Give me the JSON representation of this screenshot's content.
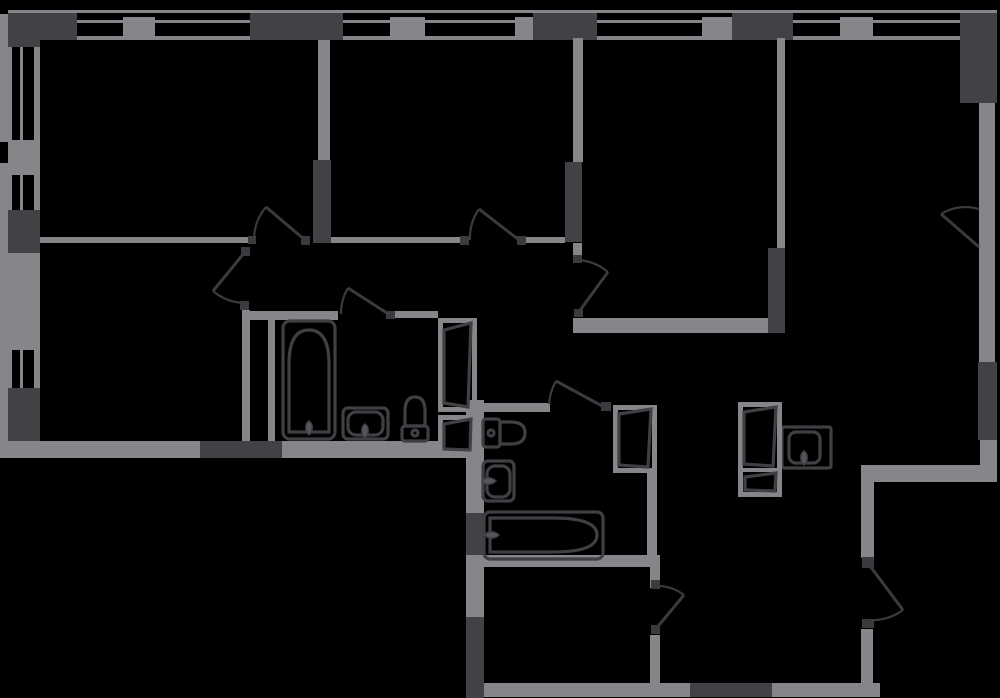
{
  "canvas": {
    "w": 1000,
    "h": 698,
    "bg": "#000000"
  },
  "palette": {
    "wall": "#85858a",
    "dark": "#414146",
    "line": "#3a3a3f",
    "fixture": "#3f3f44",
    "tap_fill": "#55555c",
    "panel_fill": "#000000"
  },
  "walls": [
    [
      8,
      10,
      989,
      3,
      "wall",
      "facade-line-top"
    ],
    [
      8,
      13,
      69,
      27,
      "dark",
      "wall-pier"
    ],
    [
      250,
      13,
      93,
      27,
      "dark",
      "wall-pier"
    ],
    [
      533,
      13,
      64,
      27,
      "dark",
      "wall-pier"
    ],
    [
      732,
      13,
      61,
      27,
      "dark",
      "wall-pier"
    ],
    [
      960,
      13,
      37,
      90,
      "dark",
      "wall-pier-corner"
    ],
    [
      123,
      17,
      32,
      23,
      "wall",
      "window-mullion"
    ],
    [
      390,
      17,
      35,
      23,
      "wall",
      "window-mullion"
    ],
    [
      515,
      17,
      18,
      23,
      "wall",
      "window-mullion"
    ],
    [
      702,
      17,
      30,
      23,
      "wall",
      "window-mullion"
    ],
    [
      840,
      17,
      33,
      23,
      "wall",
      "window-mullion"
    ],
    [
      77,
      20,
      46,
      3,
      "wall",
      "window-glazing"
    ],
    [
      155,
      20,
      95,
      3,
      "wall",
      "window-glazing"
    ],
    [
      343,
      20,
      47,
      3,
      "wall",
      "window-glazing"
    ],
    [
      425,
      20,
      90,
      3,
      "wall",
      "window-glazing"
    ],
    [
      597,
      20,
      105,
      3,
      "wall",
      "window-glazing"
    ],
    [
      793,
      20,
      47,
      3,
      "wall",
      "window-glazing"
    ],
    [
      873,
      20,
      87,
      3,
      "wall",
      "window-glazing"
    ],
    [
      77,
      36,
      46,
      4,
      "wall",
      "window-sill"
    ],
    [
      155,
      36,
      95,
      4,
      "wall",
      "window-sill"
    ],
    [
      343,
      36,
      47,
      4,
      "wall",
      "window-sill"
    ],
    [
      425,
      36,
      90,
      4,
      "wall",
      "window-sill"
    ],
    [
      597,
      36,
      105,
      4,
      "wall",
      "window-sill"
    ],
    [
      793,
      36,
      47,
      4,
      "wall",
      "window-sill"
    ],
    [
      873,
      36,
      87,
      4,
      "wall",
      "window-sill"
    ],
    [
      0,
      14,
      12,
      128,
      "wall",
      "facade-line-left"
    ],
    [
      0,
      163,
      12,
      295,
      "wall",
      "facade-line-left"
    ],
    [
      8,
      13,
      32,
      34,
      "dark",
      "wall-pier"
    ],
    [
      8,
      210,
      32,
      43,
      "dark",
      "wall-pier"
    ],
    [
      8,
      388,
      32,
      53,
      "dark",
      "wall-pier"
    ],
    [
      8,
      140,
      32,
      35,
      "wall",
      "window-mullion"
    ],
    [
      8,
      253,
      32,
      97,
      "wall",
      "wall-segment"
    ],
    [
      20,
      47,
      3,
      93,
      "wall",
      "window-glazing"
    ],
    [
      34,
      47,
      6,
      93,
      "wall",
      "window-sill"
    ],
    [
      20,
      175,
      3,
      35,
      "wall",
      "window-glazing"
    ],
    [
      34,
      175,
      6,
      35,
      "wall",
      "window-sill"
    ],
    [
      20,
      350,
      3,
      38,
      "wall",
      "window-glazing"
    ],
    [
      34,
      350,
      6,
      38,
      "wall",
      "window-sill"
    ],
    [
      8,
      441,
      192,
      17,
      "wall",
      "wall-segment"
    ],
    [
      200,
      441,
      82,
      17,
      "dark",
      "wall-segment-dark"
    ],
    [
      282,
      441,
      192,
      17,
      "wall",
      "wall-segment"
    ],
    [
      40,
      237,
      208,
      6,
      "wall",
      "wall-segment"
    ],
    [
      313,
      160,
      18,
      83,
      "dark",
      "wall-segment-dark"
    ],
    [
      318,
      40,
      12,
      120,
      "wall",
      "wall-segment"
    ],
    [
      331,
      237,
      129,
      6,
      "wall",
      "wall-segment"
    ],
    [
      526,
      237,
      39,
      6,
      "wall",
      "wall-segment"
    ],
    [
      565,
      162,
      17,
      80,
      "dark",
      "wall-segment-dark"
    ],
    [
      573,
      38,
      10,
      124,
      "wall",
      "wall-segment"
    ],
    [
      573,
      243,
      9,
      12,
      "wall",
      "wall-segment"
    ],
    [
      573,
      318,
      197,
      15,
      "wall",
      "wall-segment"
    ],
    [
      768,
      248,
      17,
      85,
      "dark",
      "wall-segment-dark"
    ],
    [
      777,
      38,
      8,
      210,
      "wall",
      "wall-segment"
    ],
    [
      242,
      310,
      8,
      131,
      "wall",
      "wall-segment"
    ],
    [
      242,
      311,
      96,
      9,
      "wall",
      "wall-segment"
    ],
    [
      394,
      311,
      44,
      7,
      "wall",
      "wall-segment"
    ],
    [
      268,
      318,
      7,
      123,
      "wall",
      "wall-segment"
    ],
    [
      466,
      400,
      18,
      113,
      "wall",
      "wall-segment"
    ],
    [
      466,
      513,
      18,
      44,
      "dark",
      "wall-segment-dark"
    ],
    [
      466,
      557,
      18,
      60,
      "wall",
      "wall-segment"
    ],
    [
      466,
      617,
      18,
      81,
      "dark",
      "wall-segment-dark"
    ],
    [
      466,
      403,
      84,
      9,
      "wall",
      "wall-segment"
    ],
    [
      647,
      473,
      10,
      92,
      "wall",
      "wall-segment"
    ],
    [
      466,
      555,
      193,
      12,
      "wall",
      "wall-segment"
    ],
    [
      650,
      555,
      10,
      33,
      "wall",
      "wall-segment"
    ],
    [
      650,
      635,
      10,
      48,
      "wall",
      "wall-segment"
    ],
    [
      484,
      683,
      206,
      14,
      "wall",
      "wall-segment"
    ],
    [
      690,
      683,
      82,
      14,
      "dark",
      "wall-segment-dark"
    ],
    [
      772,
      683,
      108,
      14,
      "wall",
      "wall-segment"
    ],
    [
      861,
      465,
      13,
      93,
      "wall",
      "wall-segment"
    ],
    [
      861,
      629,
      12,
      54,
      "wall",
      "wall-segment"
    ],
    [
      863,
      465,
      134,
      17,
      "wall",
      "wall-segment"
    ],
    [
      978,
      13,
      19,
      90,
      "dark",
      "wall-segment-dark"
    ],
    [
      979,
      103,
      16,
      259,
      "wall",
      "window-band-right"
    ],
    [
      978,
      362,
      19,
      78,
      "dark",
      "wall-segment-dark"
    ],
    [
      980,
      440,
      17,
      28,
      "wall",
      "wall-segment"
    ]
  ],
  "hinges": [
    [
      248,
      236,
      8,
      8
    ],
    [
      301,
      236,
      9,
      9
    ],
    [
      460,
      236,
      9,
      9
    ],
    [
      517,
      236,
      9,
      9
    ],
    [
      241,
      247,
      9,
      9
    ],
    [
      240,
      301,
      9,
      9
    ],
    [
      386,
      311,
      9,
      8
    ],
    [
      573,
      255,
      9,
      8
    ],
    [
      574,
      309,
      9,
      8
    ],
    [
      601,
      402,
      10,
      9
    ],
    [
      651,
      580,
      9,
      9
    ],
    [
      651,
      625,
      9,
      9
    ],
    [
      862,
      557,
      12,
      11
    ],
    [
      862,
      619,
      12,
      9
    ]
  ],
  "doors": [
    {
      "name": "door-bedroom-top-left",
      "h": [
        305,
        240
      ],
      "t": [
        266,
        207
      ],
      "j": [
        254,
        240
      ],
      "r": 51,
      "s": 0
    },
    {
      "name": "door-bedroom-top-mid",
      "h": [
        519,
        240
      ],
      "t": [
        479,
        209
      ],
      "j": [
        470,
        240
      ],
      "r": 50,
      "s": 0
    },
    {
      "name": "door-bedroom-bottom-left",
      "h": [
        245,
        252
      ],
      "t": [
        213,
        291
      ],
      "j": [
        244,
        303
      ],
      "r": 51,
      "s": 0
    },
    {
      "name": "door-bathroom-1",
      "h": [
        390,
        315
      ],
      "t": [
        348,
        288
      ],
      "j": [
        341,
        314
      ],
      "r": 49,
      "s": 0
    },
    {
      "name": "door-bedroom-mid-right",
      "h": [
        578,
        313
      ],
      "t": [
        608,
        272
      ],
      "j": [
        578,
        260
      ],
      "r": 52,
      "s": 0
    },
    {
      "name": "door-bathroom-2",
      "h": [
        604,
        407
      ],
      "t": [
        556,
        381
      ],
      "j": [
        549,
        404
      ],
      "r": 55,
      "s": 0
    },
    {
      "name": "door-storage",
      "h": [
        655,
        630
      ],
      "t": [
        684,
        595
      ],
      "j": [
        655,
        586
      ],
      "r": 45,
      "s": 0
    },
    {
      "name": "door-entrance",
      "h": [
        870,
        566
      ],
      "t": [
        903,
        610
      ],
      "j": [
        866,
        620
      ],
      "r": 55,
      "s": 1
    },
    {
      "name": "window-swing-living",
      "h": [
        979,
        247
      ],
      "t": [
        941,
        214
      ],
      "j": [
        979,
        209
      ],
      "r": 47,
      "s": 1
    }
  ],
  "fixtures": [
    {
      "name": "bathtub-1",
      "parts": [
        {
          "t": "rect",
          "a": {
            "x": 283,
            "y": 321,
            "width": 52,
            "height": 118,
            "rx": 7
          }
        },
        {
          "t": "path",
          "a": {
            "d": "M289,432 V364 Q289,330 309,330 Q329,330 329,364 V432 Z"
          }
        },
        {
          "t": "tap",
          "x": 309,
          "y": 428,
          "rot": 0
        }
      ]
    },
    {
      "name": "sink-bathroom-1",
      "parts": [
        {
          "t": "rect",
          "a": {
            "x": 343,
            "y": 408,
            "width": 45,
            "height": 31,
            "rx": 5
          }
        },
        {
          "t": "rect",
          "a": {
            "x": 348,
            "y": 412,
            "width": 35,
            "height": 23,
            "rx": 8
          }
        },
        {
          "t": "tap",
          "x": 365,
          "y": 431,
          "rot": 0
        }
      ]
    },
    {
      "name": "toilet-1",
      "parts": [
        {
          "t": "rect",
          "a": {
            "x": 402,
            "y": 426,
            "width": 26,
            "height": 15,
            "rx": 3
          }
        },
        {
          "t": "path",
          "a": {
            "d": "M405,426 V411 Q405,397 415,397 Q425,397 425,411 V426 Z"
          }
        },
        {
          "t": "circle",
          "a": {
            "cx": 415,
            "cy": 433,
            "r": 3
          }
        }
      ]
    },
    {
      "name": "toilet-2",
      "parts": [
        {
          "t": "rect",
          "a": {
            "x": 483,
            "y": 419,
            "width": 17,
            "height": 28,
            "rx": 3
          }
        },
        {
          "t": "path",
          "a": {
            "d": "M500,422 H511 Q525,422 525,433 Q525,444 511,444 H500 Z"
          }
        },
        {
          "t": "circle",
          "a": {
            "cx": 491,
            "cy": 433,
            "r": 3
          }
        }
      ]
    },
    {
      "name": "sink-bathroom-2",
      "parts": [
        {
          "t": "rect",
          "a": {
            "x": 483,
            "y": 461,
            "width": 31,
            "height": 40,
            "rx": 5
          }
        },
        {
          "t": "rect",
          "a": {
            "x": 487,
            "y": 466,
            "width": 23,
            "height": 31,
            "rx": 8
          }
        },
        {
          "t": "tap",
          "x": 489,
          "y": 481,
          "rot": -90
        }
      ]
    },
    {
      "name": "bathtub-2",
      "parts": [
        {
          "t": "rect",
          "a": {
            "x": 484,
            "y": 512,
            "width": 119,
            "height": 47,
            "rx": 6
          }
        },
        {
          "t": "path",
          "a": {
            "d": "M490,518 H553 Q597,518 597,535 Q597,552 553,552 H490 Z"
          }
        },
        {
          "t": "tap",
          "x": 492,
          "y": 535,
          "rot": -90
        }
      ]
    },
    {
      "name": "kitchen-sink",
      "parts": [
        {
          "t": "rect",
          "a": {
            "x": 782,
            "y": 427,
            "width": 49,
            "height": 41,
            "rx": 2
          }
        },
        {
          "t": "rect",
          "a": {
            "x": 789,
            "y": 432,
            "width": 31,
            "height": 31,
            "rx": 7
          }
        },
        {
          "t": "tap",
          "x": 804,
          "y": 458,
          "rot": 0
        }
      ]
    },
    {
      "name": "vent-shaft-1-upper",
      "parts": [
        {
          "t": "rect",
          "a": {
            "x": 440.5,
            "y": 320.5,
            "width": 34,
            "height": 89,
            "stroke": "#85858a",
            "stroke-width": 5
          }
        },
        {
          "t": "path",
          "a": {
            "d": "M444,330 L471,323 L468,407 L444,403 Z",
            "fill": "#000000"
          }
        }
      ]
    },
    {
      "name": "vent-shaft-1-lower",
      "parts": [
        {
          "t": "rect",
          "a": {
            "x": 440.5,
            "y": 417.5,
            "width": 34,
            "height": 37,
            "stroke": "#85858a",
            "stroke-width": 5
          }
        },
        {
          "t": "path",
          "a": {
            "d": "M444,424 L471,419 L470,450 L444,449 Z",
            "fill": "#000000"
          }
        }
      ]
    },
    {
      "name": "vent-shaft-2",
      "parts": [
        {
          "t": "rect",
          "a": {
            "x": 615.5,
            "y": 407.5,
            "width": 39,
            "height": 63,
            "stroke": "#85858a",
            "stroke-width": 5
          }
        },
        {
          "t": "path",
          "a": {
            "d": "M619,414 L651,409 L648,467 L619,465 Z",
            "fill": "#000000"
          }
        }
      ]
    },
    {
      "name": "vent-shaft-3",
      "parts": [
        {
          "t": "rect",
          "a": {
            "x": 740.5,
            "y": 404.5,
            "width": 39,
            "height": 90,
            "stroke": "#85858a",
            "stroke-width": 5
          }
        },
        {
          "t": "path",
          "a": {
            "d": "M740,470 L780,470",
            "stroke": "#85858a",
            "stroke-width": 4
          }
        },
        {
          "t": "path",
          "a": {
            "d": "M744,412 L776,407 L773,466 L744,464 Z",
            "fill": "#000000"
          }
        },
        {
          "t": "path",
          "a": {
            "d": "M745,477 L776,473 L775,491 L745,490 Z",
            "fill": "#000000"
          }
        }
      ]
    }
  ]
}
